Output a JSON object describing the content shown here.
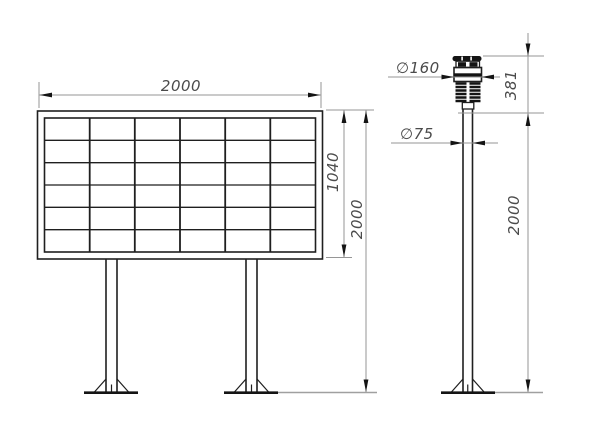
{
  "front_view": {
    "dim_width": "2000",
    "dim_panel_height": "1040",
    "dim_total_height": "2000",
    "grid_rows": 6,
    "grid_columns": 6
  },
  "side_view": {
    "dim_head_diameter": "∅160",
    "dim_pole_diameter": "∅75",
    "dim_head_height": "381",
    "dim_pole_height": "2000"
  },
  "colors": {
    "background": "#ffffff",
    "object_line": "#1f1f1f",
    "dimension_line": "#969696",
    "dimension_text": "#4b4b4b"
  }
}
